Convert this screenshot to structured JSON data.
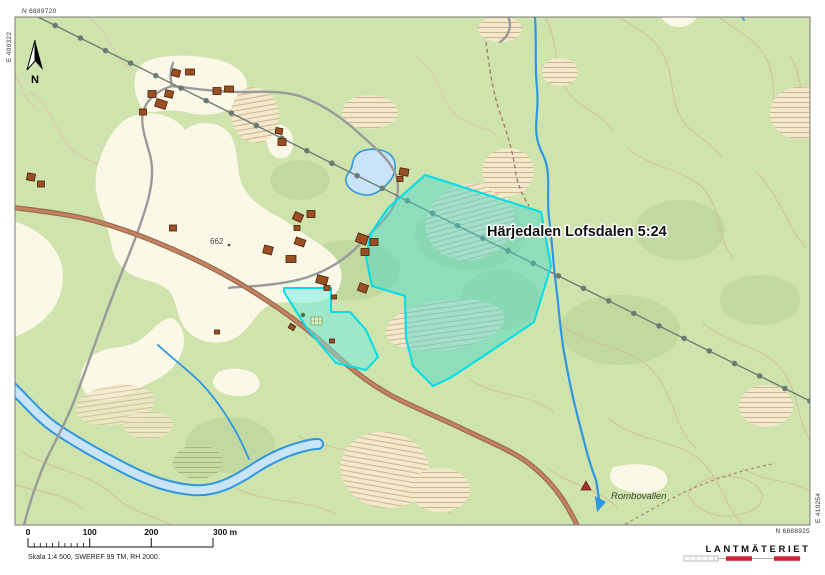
{
  "map": {
    "title_label": "Härjedalen Lofsdalen 5:24",
    "place_label": "Rombovallen",
    "elevation_label": "662",
    "north_label": "N",
    "corner_coords": {
      "top_n": "N 6889720",
      "left_e": "E 409322",
      "right_e": "E 410254",
      "bottom_n": "N 6888925"
    }
  },
  "scale_bar": {
    "ticks": [
      "0",
      "100",
      "200"
    ],
    "end_label": "300 m",
    "caption": "Skala 1:4 500, SWEREF 99 TM, RH 2000."
  },
  "logo": {
    "text": "LANTMÄTERIET"
  },
  "colors": {
    "map_green": "#cfe3ad",
    "open_land": "#fcf8e8",
    "marsh": "#f4e8cd",
    "water_line": "#2f97e0",
    "water_fill": "#c9e3f7",
    "road_main_fill": "#c8805f",
    "road_main_casing": "#8f6b52",
    "road_secondary": "#9a9a9a",
    "power_line": "#6c7c74",
    "property_stroke": "#00dce8",
    "property_fill": "rgba(64,216,205,0.45)",
    "building": "#9c4f22",
    "contour": "#d3bd95",
    "logo_red": "#cc2233"
  }
}
